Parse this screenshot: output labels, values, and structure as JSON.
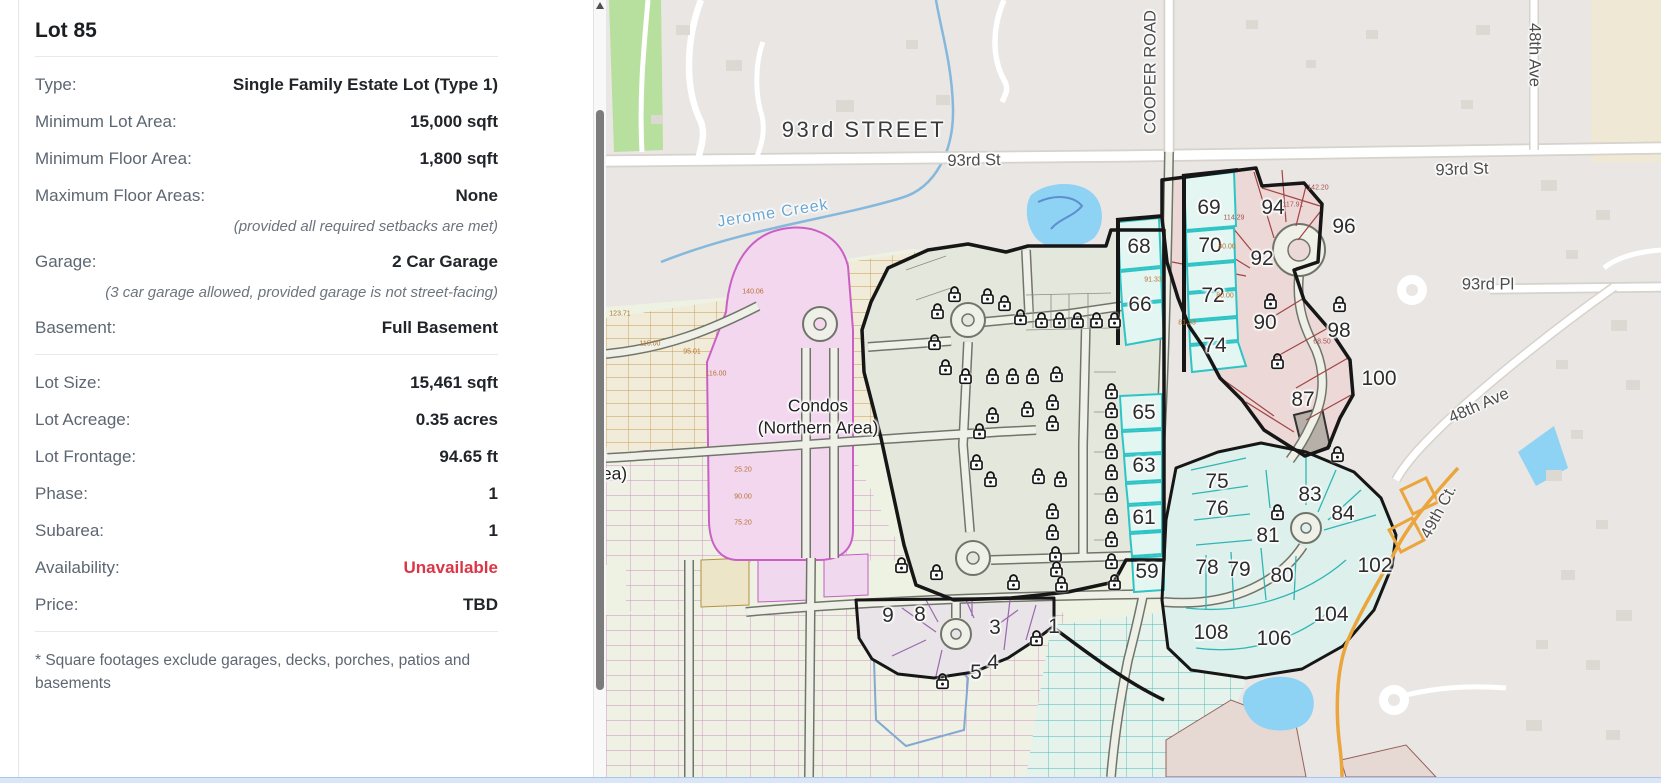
{
  "panel": {
    "title": "Lot 85",
    "rows": [
      {
        "label": "Type:",
        "value": "Single Family Estate Lot (Type 1)"
      },
      {
        "label": "Minimum Lot Area:",
        "value": "15,000 sqft"
      },
      {
        "label": "Minimum Floor Area:",
        "value": "1,800 sqft"
      },
      {
        "label": "Maximum Floor Areas:",
        "value": "None"
      },
      {
        "note": "(provided all required setbacks are met)"
      },
      {
        "label": "Garage:",
        "value": "2 Car Garage"
      },
      {
        "note": "(3 car garage allowed, provided garage is not street-facing)"
      },
      {
        "label": "Basement:",
        "value": "Full Basement"
      },
      {
        "divider": true
      },
      {
        "label": "Lot Size:",
        "value": "15,461 sqft"
      },
      {
        "label": "Lot Acreage:",
        "value": "0.35 acres"
      },
      {
        "label": "Lot Frontage:",
        "value": "94.65 ft"
      },
      {
        "label": "Phase:",
        "value": "1"
      },
      {
        "label": "Subarea:",
        "value": "1"
      },
      {
        "label": "Availability:",
        "value": "Unavailable",
        "value_color": "#dc3545"
      },
      {
        "label": "Price:",
        "value": "TBD"
      },
      {
        "divider": true
      }
    ],
    "footnote": "* Square footages exclude garages, decks, porches, patios and basements",
    "unavailable_color": "#dc3545"
  },
  "map": {
    "street_labels": [
      {
        "t": "93rd STREET",
        "x": 258,
        "y": 130,
        "r": 0,
        "s": "big"
      },
      {
        "t": "93rd St",
        "x": 368,
        "y": 161,
        "r": -1,
        "s": "med"
      },
      {
        "t": "93rd St",
        "x": 856,
        "y": 170,
        "r": -2,
        "s": "med"
      },
      {
        "t": "COOPER ROAD",
        "x": 545,
        "y": 72,
        "r": -90,
        "s": "med"
      },
      {
        "t": "48th Ave",
        "x": 928,
        "y": 55,
        "r": 90,
        "s": "med"
      },
      {
        "t": "93rd Pl",
        "x": 882,
        "y": 285,
        "r": 0,
        "s": "med"
      },
      {
        "t": "48th Ave",
        "x": 873,
        "y": 406,
        "r": -24,
        "s": "med"
      },
      {
        "t": "49th Ct.",
        "x": 833,
        "y": 512,
        "r": -62,
        "s": "med"
      },
      {
        "t": "Jerome Creek",
        "x": 167,
        "y": 214,
        "r": -9,
        "s": "water"
      }
    ],
    "area_labels": [
      {
        "t": "Condos",
        "x": 212,
        "y": 406
      },
      {
        "t": "(Northern Area)",
        "x": 212,
        "y": 428
      },
      {
        "t": "dos",
        "x": -14,
        "y": 452
      },
      {
        "t": "rn Area)",
        "x": -10,
        "y": 474
      }
    ],
    "lots": [
      {
        "n": "68",
        "x": 533,
        "y": 247
      },
      {
        "n": "66",
        "x": 534,
        "y": 305
      },
      {
        "n": "69",
        "x": 603,
        "y": 208
      },
      {
        "n": "70",
        "x": 604,
        "y": 246
      },
      {
        "n": "72",
        "x": 607,
        "y": 296
      },
      {
        "n": "74",
        "x": 609,
        "y": 346
      },
      {
        "n": "65",
        "x": 538,
        "y": 413
      },
      {
        "n": "63",
        "x": 538,
        "y": 466
      },
      {
        "n": "61",
        "x": 538,
        "y": 518
      },
      {
        "n": "59",
        "x": 541,
        "y": 572
      },
      {
        "n": "94",
        "x": 667,
        "y": 208
      },
      {
        "n": "96",
        "x": 738,
        "y": 227
      },
      {
        "n": "92",
        "x": 656,
        "y": 259
      },
      {
        "n": "90",
        "x": 659,
        "y": 323
      },
      {
        "n": "98",
        "x": 733,
        "y": 331
      },
      {
        "n": "100",
        "x": 773,
        "y": 379
      },
      {
        "n": "87",
        "x": 697,
        "y": 400
      },
      {
        "n": "75",
        "x": 611,
        "y": 482
      },
      {
        "n": "76",
        "x": 611,
        "y": 509
      },
      {
        "n": "83",
        "x": 704,
        "y": 495
      },
      {
        "n": "84",
        "x": 737,
        "y": 514
      },
      {
        "n": "81",
        "x": 662,
        "y": 536
      },
      {
        "n": "78",
        "x": 601,
        "y": 568
      },
      {
        "n": "79",
        "x": 633,
        "y": 570
      },
      {
        "n": "80",
        "x": 676,
        "y": 576
      },
      {
        "n": "102",
        "x": 769,
        "y": 566
      },
      {
        "n": "104",
        "x": 725,
        "y": 615
      },
      {
        "n": "106",
        "x": 668,
        "y": 639
      },
      {
        "n": "108",
        "x": 605,
        "y": 633
      },
      {
        "n": "9",
        "x": 282,
        "y": 616
      },
      {
        "n": "8",
        "x": 314,
        "y": 615
      },
      {
        "n": "3",
        "x": 389,
        "y": 628
      },
      {
        "n": "1",
        "x": 448,
        "y": 627
      },
      {
        "n": "4",
        "x": 387,
        "y": 663
      },
      {
        "n": "5",
        "x": 370,
        "y": 673
      }
    ],
    "locks": [
      [
        340,
        285
      ],
      [
        373,
        287
      ],
      [
        390,
        294
      ],
      [
        323,
        302
      ],
      [
        406,
        308
      ],
      [
        427,
        311
      ],
      [
        445,
        311
      ],
      [
        463,
        311
      ],
      [
        482,
        311
      ],
      [
        500,
        311
      ],
      [
        320,
        333
      ],
      [
        331,
        358
      ],
      [
        351,
        367
      ],
      [
        378,
        367
      ],
      [
        398,
        367
      ],
      [
        418,
        367
      ],
      [
        442,
        365
      ],
      [
        378,
        406
      ],
      [
        413,
        400
      ],
      [
        438,
        393
      ],
      [
        438,
        414
      ],
      [
        365,
        422
      ],
      [
        362,
        453
      ],
      [
        376,
        470
      ],
      [
        424,
        467
      ],
      [
        446,
        470
      ],
      [
        438,
        502
      ],
      [
        438,
        523
      ],
      [
        441,
        545
      ],
      [
        287,
        556
      ],
      [
        322,
        563
      ],
      [
        399,
        573
      ],
      [
        442,
        560
      ],
      [
        447,
        575
      ],
      [
        497,
        382
      ],
      [
        497,
        401
      ],
      [
        497,
        422
      ],
      [
        497,
        442
      ],
      [
        497,
        463
      ],
      [
        497,
        485
      ],
      [
        497,
        507
      ],
      [
        497,
        530
      ],
      [
        497,
        552
      ],
      [
        500,
        573
      ],
      [
        656,
        292
      ],
      [
        725,
        295
      ],
      [
        663,
        352
      ],
      [
        723,
        445
      ],
      [
        663,
        503
      ],
      [
        328,
        672
      ],
      [
        422,
        629
      ]
    ],
    "dimensions": [
      {
        "t": "123.71",
        "x": 14,
        "y": 314
      },
      {
        "t": "115.00",
        "x": 44,
        "y": 344
      },
      {
        "t": "95.01",
        "x": 86,
        "y": 352
      },
      {
        "t": "116.00",
        "x": 110,
        "y": 374
      },
      {
        "t": "140.06",
        "x": 147,
        "y": 292
      },
      {
        "t": "114.29",
        "x": 628,
        "y": 218,
        "c": "#a85252"
      },
      {
        "t": "117.91",
        "x": 687,
        "y": 205,
        "c": "#a85252"
      },
      {
        "t": "142.20",
        "x": 712,
        "y": 188,
        "c": "#a85252"
      },
      {
        "t": "80.00",
        "x": 621,
        "y": 247
      },
      {
        "t": "80.00",
        "x": 619,
        "y": 296
      },
      {
        "t": "81.33",
        "x": 581,
        "y": 323
      },
      {
        "t": "91.33",
        "x": 547,
        "y": 280
      },
      {
        "t": "25.20",
        "x": 137,
        "y": 470
      },
      {
        "t": "90.00",
        "x": 137,
        "y": 497
      },
      {
        "t": "75.20",
        "x": 137,
        "y": 523
      },
      {
        "t": "68.50",
        "x": 716,
        "y": 342,
        "c": "#a85252"
      }
    ],
    "colors": {
      "available_cyan": "#2ec4c6",
      "unavailable_red_region": "#ecd8d6",
      "condos_magenta": "#cb5fc6",
      "teal_region_border": "#16a0a8",
      "orange_road": "#eaa53c",
      "water": "#8ed2f4"
    }
  }
}
